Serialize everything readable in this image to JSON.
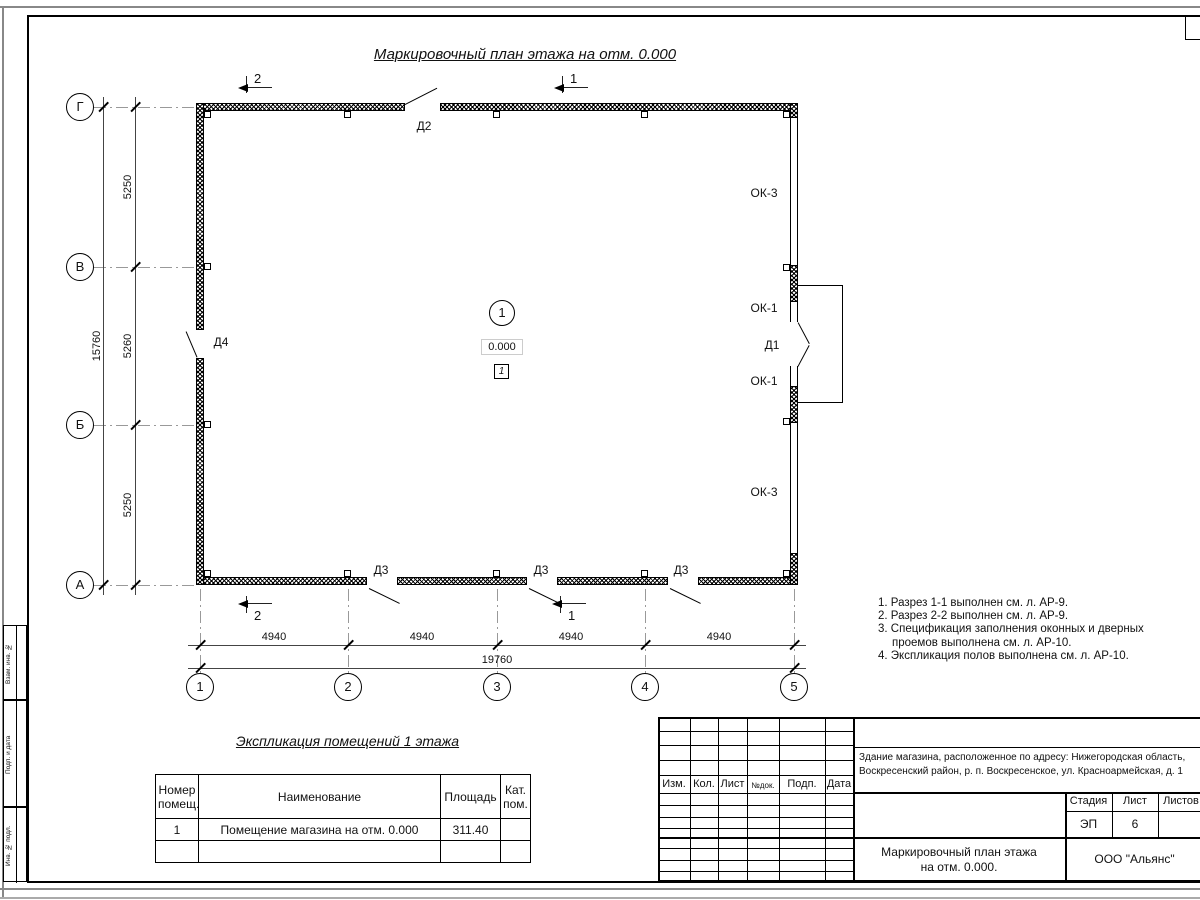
{
  "sheet": {
    "plan_title": "Маркировочный план этажа на отм. 0.000"
  },
  "plan": {
    "axes_bottom": [
      "1",
      "2",
      "3",
      "4",
      "5"
    ],
    "axes_left": [
      "Г",
      "В",
      "Б",
      "А"
    ],
    "dims_left": [
      "5250",
      "5260",
      "5250"
    ],
    "dim_left_total": "15760",
    "dims_bottom": [
      "4940",
      "4940",
      "4940",
      "4940"
    ],
    "dim_bottom_total": "19760",
    "doors": {
      "d1": "Д1",
      "d2": "Д2",
      "d3": "Д3",
      "d4": "Д4"
    },
    "windows": {
      "ok1": "ОК-1",
      "ok3": "ОК-3"
    },
    "room": {
      "number": "1",
      "elevation": "0.000",
      "floor_mark": "1"
    },
    "sections": {
      "s1": "1",
      "s2": "2"
    }
  },
  "notes": [
    "1. Разрез 1-1 выполнен см. л. АР-9.",
    "2. Разрез 2-2 выполнен см. л. АР-9.",
    "3. Спецификация заполнения оконных и дверных",
    "проемов выполнена см. л. АР-10.",
    "4. Экспликация полов выполнена см. л. АР-10."
  ],
  "explication": {
    "title": "Экспликация помещений 1 этажа",
    "headers": [
      "Номер помещ.",
      "Наименование",
      "Площадь",
      "Кат. пом."
    ],
    "rows": [
      [
        "1",
        "Помещение магазина на отм. 0.000",
        "311.40",
        ""
      ]
    ]
  },
  "titleblock": {
    "rev_headers": [
      "Изм.",
      "Кол.",
      "Лист",
      "№док.",
      "Подп.",
      "Дата"
    ],
    "project_line1": "Здание магазина, расположенное по адресу: Нижегородская область,",
    "project_line2": "Воскресенский район, р. п. Воскресенское, ул. Красноармейская, д. 1",
    "stage_headers": [
      "Стадия",
      "Лист",
      "Листов"
    ],
    "stage_value": "ЭП",
    "sheet_value": "6",
    "sheets_value": "",
    "drawing_title": "Маркировочный план этажа на отм. 0.000.",
    "company": "ООО \"Альянс\""
  },
  "side_stamp": [
    "Взам. инв. №",
    "Подп. и дата",
    "Инв. № подл."
  ]
}
